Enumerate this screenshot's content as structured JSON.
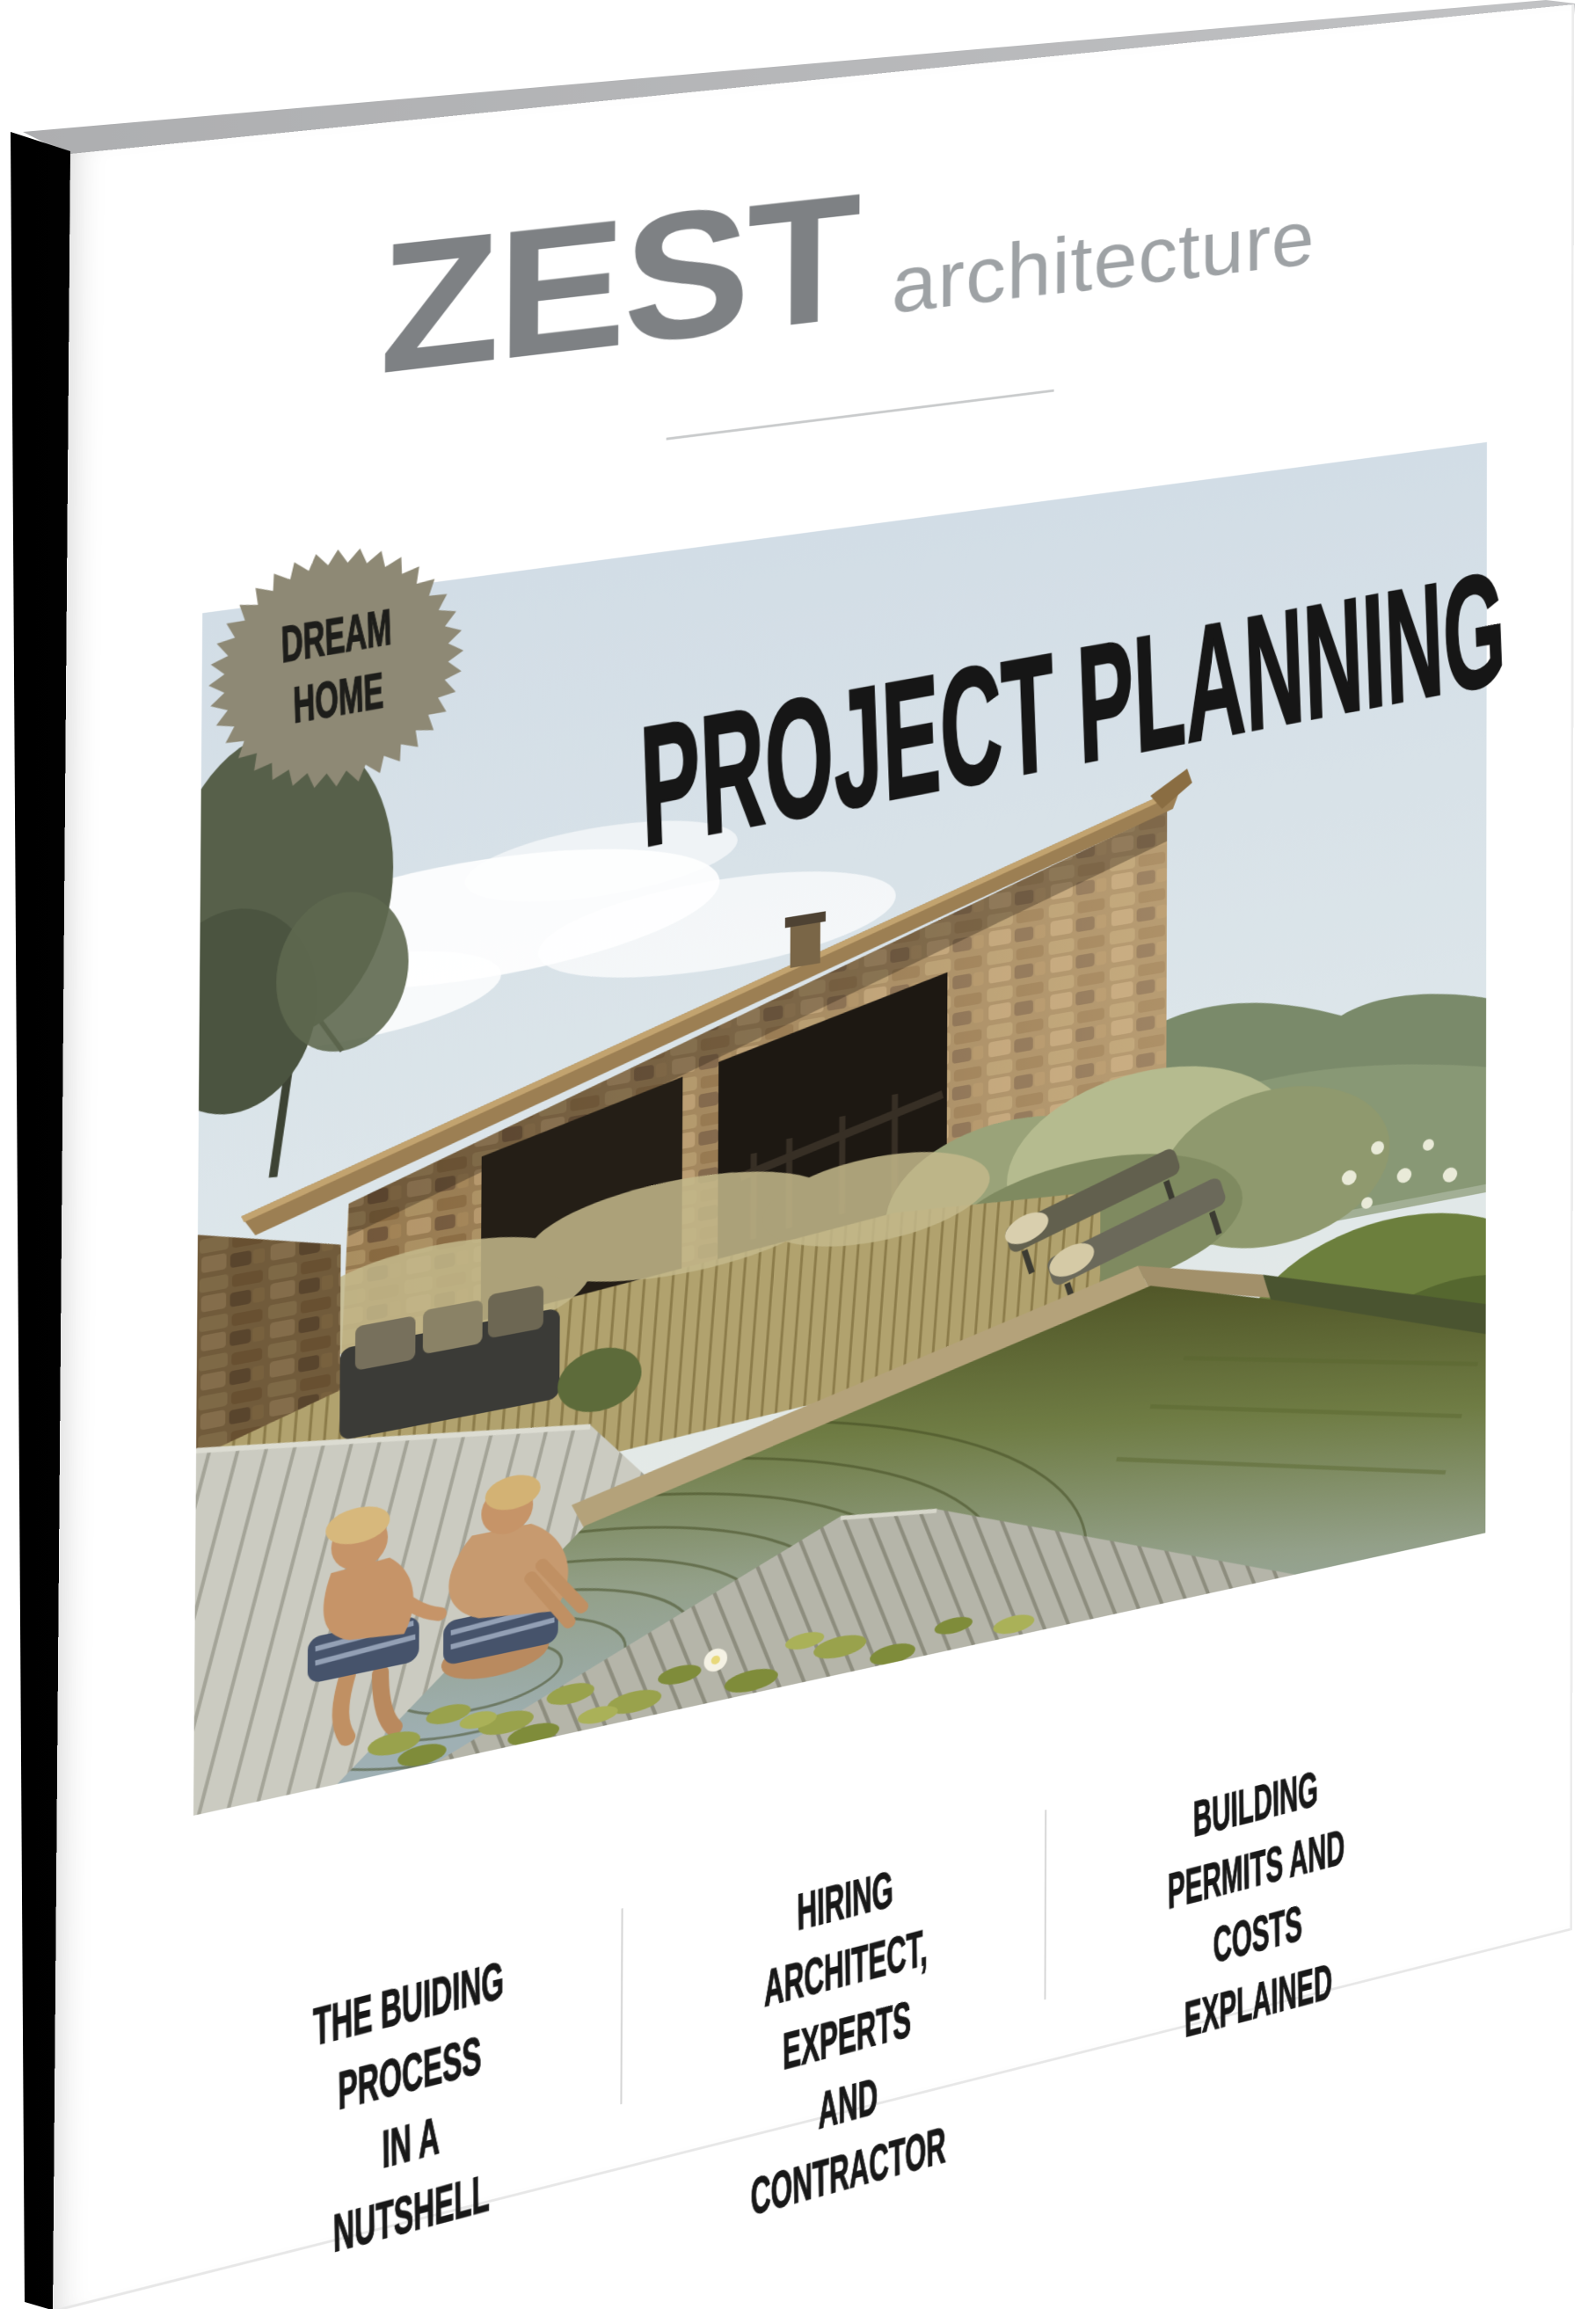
{
  "brand": {
    "name": "ZEST",
    "descriptor": "architecture"
  },
  "badge": {
    "text": "DREAM\nHOME",
    "shape": "starburst-seal"
  },
  "title": {
    "text": "PROJECT PLANNING"
  },
  "teasers": [
    {
      "text": "THE BUIDING PROCESS\nIN A NUTSHELL"
    },
    {
      "text": "HIRING ARCHITECT, EXPERTS\nAND CONTRACTOR"
    },
    {
      "text": "BUILDING PERMITS AND\nCOSTS EXPLAINED"
    }
  ],
  "colors": {
    "badge_fill": "#8e8975",
    "logo_primary": "#7e8184",
    "logo_secondary": "#9ea2a5",
    "heading_text": "#161616",
    "teaser_text": "#181818",
    "spine": "#0a0a0a",
    "pages_edge": "#b3b4b6",
    "divider": "#c9cbcc"
  }
}
